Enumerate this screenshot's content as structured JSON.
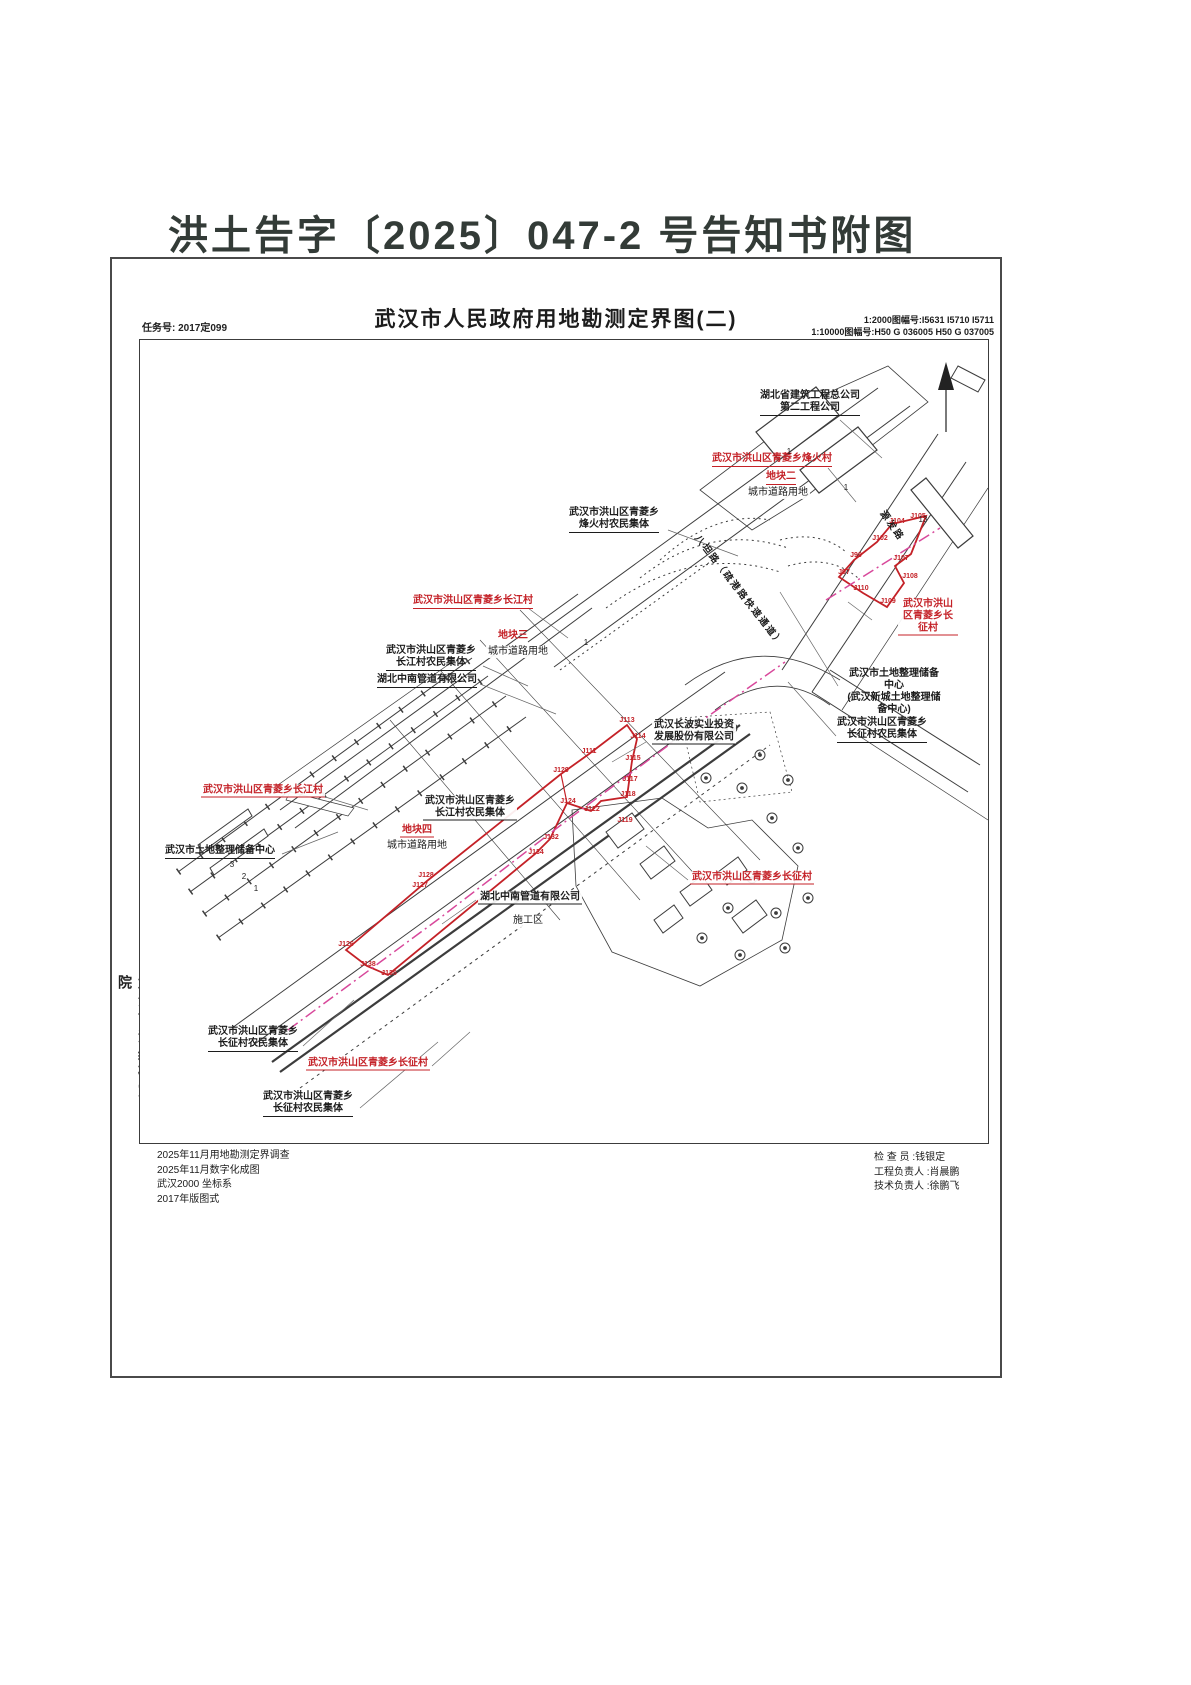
{
  "page_title": "洪土告字〔2025〕047-2 号告知书附图",
  "header": {
    "task_no": "任务号: 2017定099",
    "title": "武汉市人民政府用地勘测定界图(二)",
    "sheet_2000": "1:2000图幅号:I5631 I5710 I5711",
    "sheet_10000": "1:10000图幅号:H50 G 036005 H50 G 037005"
  },
  "sidebar": {
    "agency": "武汉市测绘研究院"
  },
  "notes_left": [
    "2025年11月用地勘测定界调查",
    "2025年11月数字化成图",
    "武汉2000 坐标系",
    "2017年版图式"
  ],
  "notes_right": [
    "检 查 员 :钱银定",
    "工程负责人 :肖晨鹏",
    "技术负责人 :徐鹏飞"
  ],
  "map": {
    "red_labels": [
      {
        "text": "武汉市洪山区青菱乡烽火村"
      },
      {
        "text": "地块二"
      },
      {
        "text": "武汉市洪山区青菱乡长征村"
      },
      {
        "text": "武汉市洪山区青菱乡长江村"
      },
      {
        "text": "地块三"
      },
      {
        "text": "武汉市洪山区青菱乡长江村"
      },
      {
        "text": "地块四"
      },
      {
        "text": "武汉市洪山区青菱乡长征村"
      },
      {
        "text": "武汉市洪山区青菱乡长征村"
      }
    ],
    "black_labels": [
      {
        "text": "湖北省建筑工程总公司\n第二工程公司"
      },
      {
        "text": "武汉市洪山区青菱乡\n烽火村农民集体"
      },
      {
        "text": "城市道路用地"
      },
      {
        "text": "武汉市洪山区青菱乡\n长江村农民集体"
      },
      {
        "text": "湖北中南管道有限公司"
      },
      {
        "text": "城市道路用地"
      },
      {
        "text": "武汉长波实业投资\n发展股份有限公司"
      },
      {
        "text": "武汉市土地整理储备中心\n(武汉新城土地整理储备中心)"
      },
      {
        "text": "武汉市洪山区青菱乡\n长征村农民集体"
      },
      {
        "text": "武汉市洪山区青菱乡\n长江村农民集体"
      },
      {
        "text": "城市道路用地"
      },
      {
        "text": "武汉市土地整理储备中心"
      },
      {
        "text": "湖北中南管道有限公司"
      },
      {
        "text": "施工区"
      },
      {
        "text": "武汉市洪山区青菱乡\n长征村农民集体"
      },
      {
        "text": "武汉市洪山区青菱乡\n长征村农民集体"
      }
    ],
    "road_labels": [
      {
        "text": "八坦路（疏港路快速通道）"
      },
      {
        "text": "源发路"
      }
    ],
    "boundary_points": [
      "J97",
      "J99",
      "J102",
      "J104",
      "J105",
      "J107",
      "J108",
      "J109",
      "J110",
      "J111",
      "J113",
      "J114",
      "J115",
      "J117",
      "J118",
      "J119",
      "J122",
      "J124",
      "J126",
      "J127",
      "J128",
      "J129",
      "J132",
      "J134",
      "J135",
      "J138"
    ],
    "parcel_numbers": [
      "1",
      "1",
      "13",
      "1",
      "3",
      "2",
      "1"
    ],
    "colors": {
      "boundary_red": "#c42127",
      "pipeline_magenta": "#d8489b",
      "line_dark": "#3c3c3c"
    }
  }
}
